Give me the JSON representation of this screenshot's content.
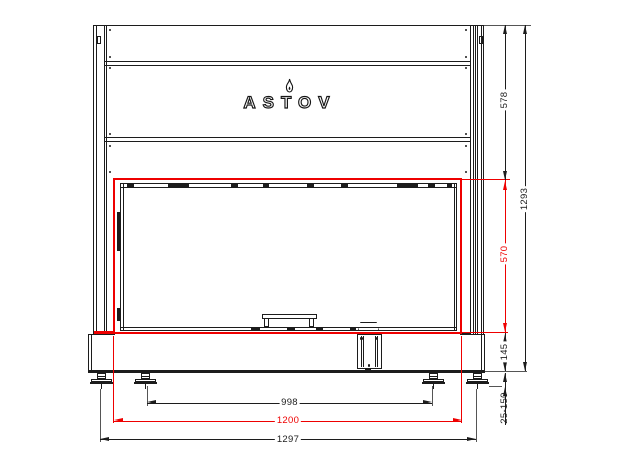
{
  "brand": {
    "name": "ASTOV"
  },
  "icons": {
    "brand_flame": "flame-icon"
  },
  "colors": {
    "line": "#1c1c1c",
    "accent_red": "#ee0000",
    "background": "#ffffff"
  },
  "dimensions": {
    "top_section_height": "578",
    "overall_height": "1293",
    "opening_height": "570",
    "base_height": "145",
    "leg_adjust_range": "25-150",
    "feet_spacing": "998",
    "opening_width": "1200",
    "overall_width": "1297"
  }
}
